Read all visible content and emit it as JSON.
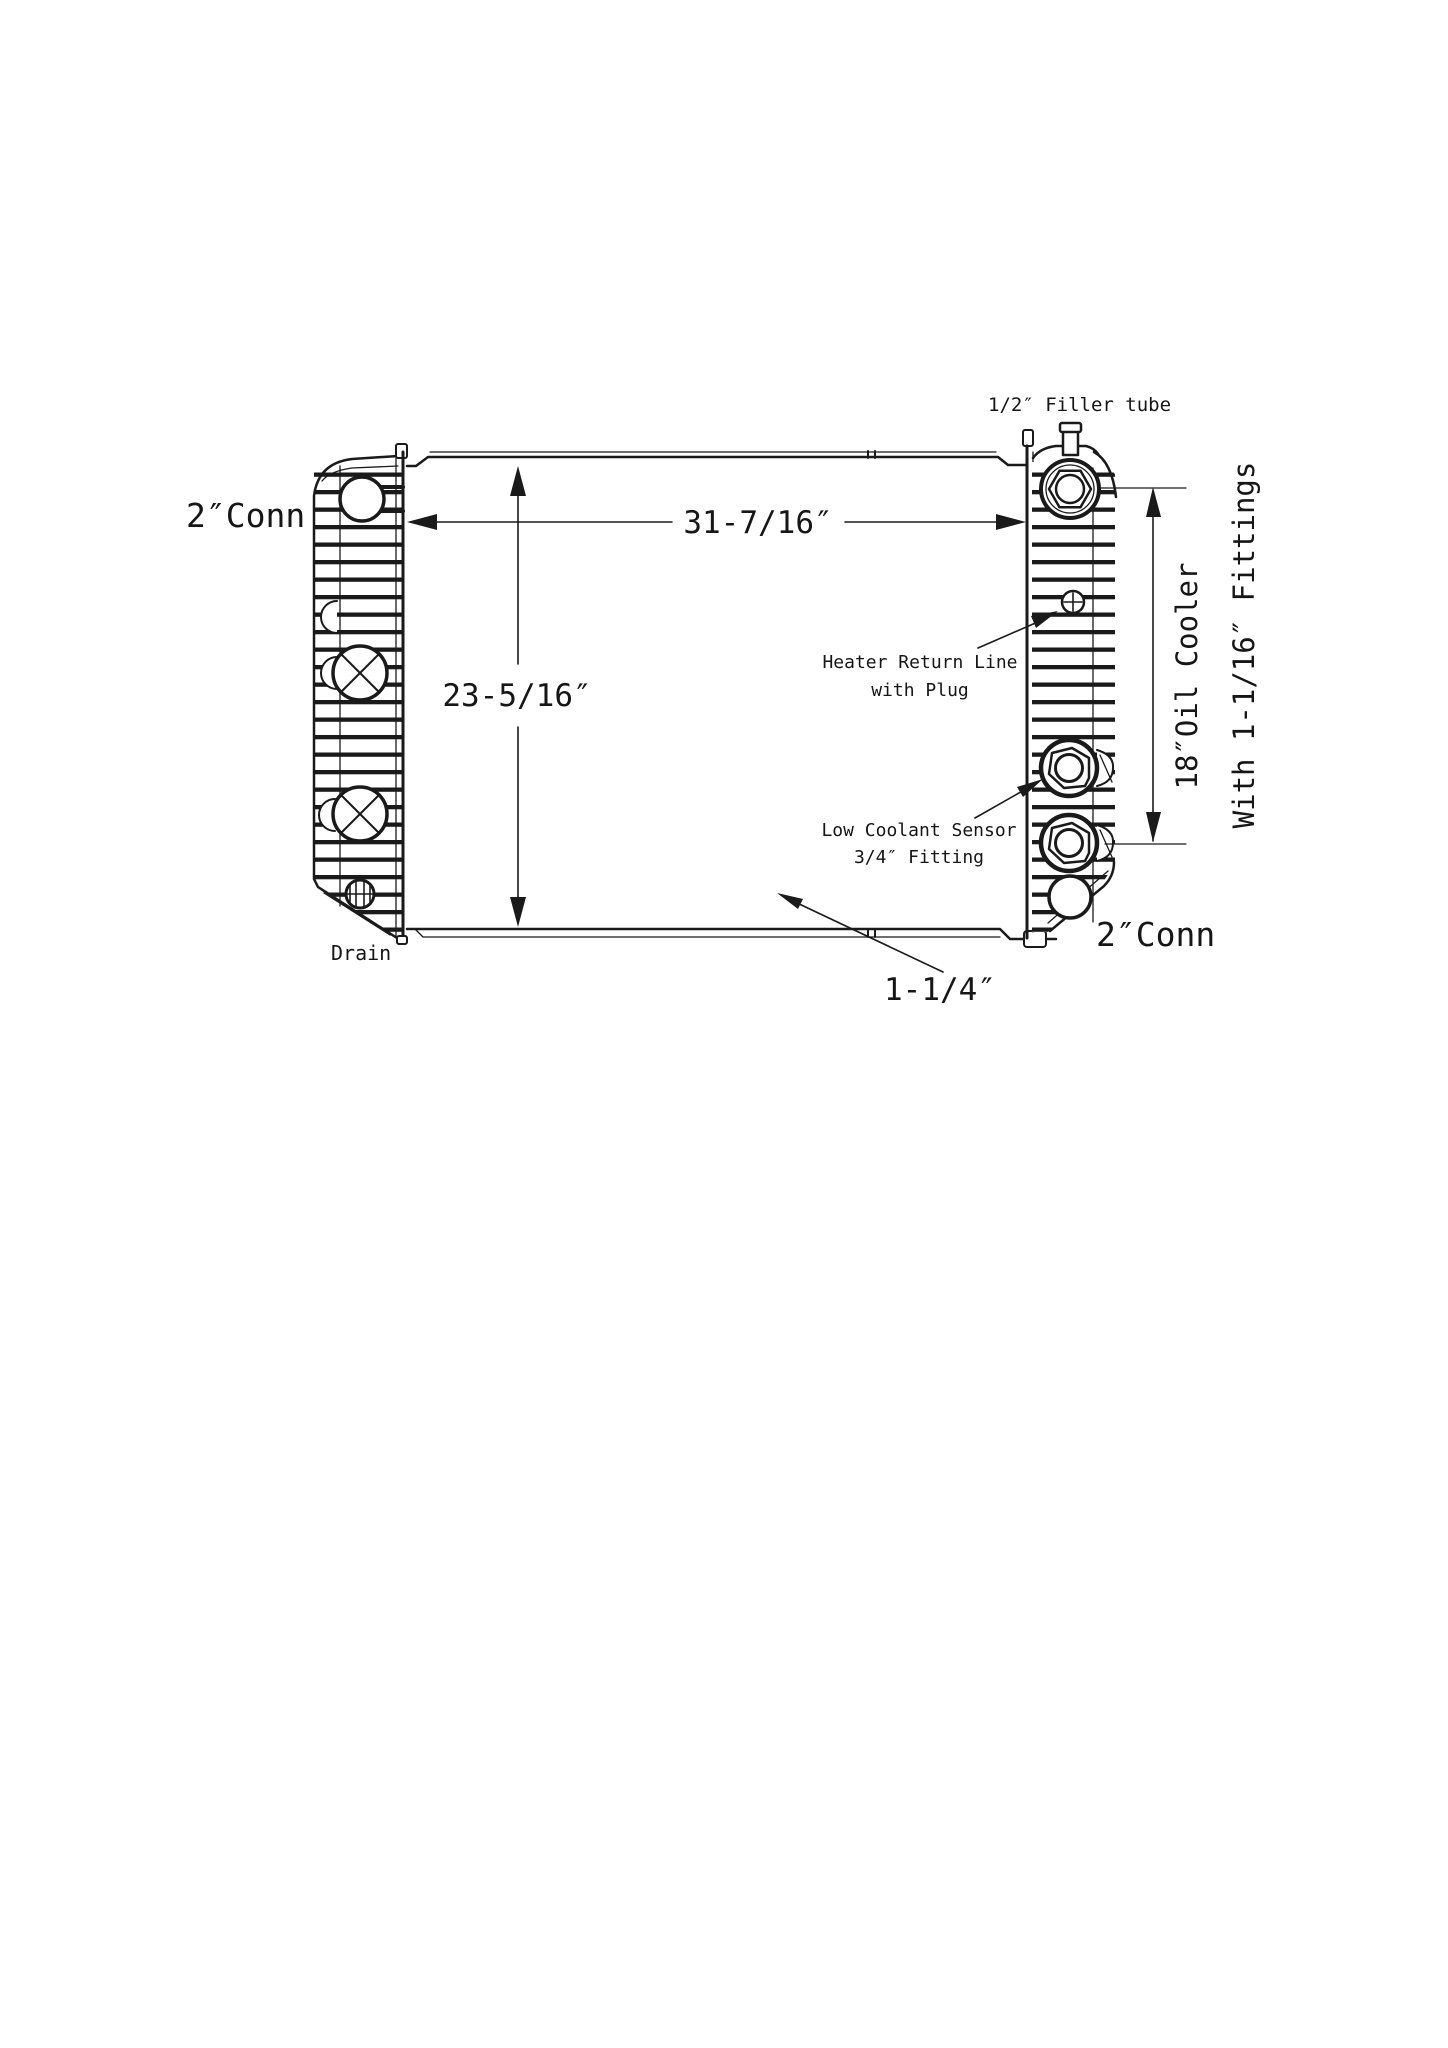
{
  "drawing": {
    "background": "#ffffff",
    "line_color": "#1a1a1a",
    "labels": {
      "top_left_conn": "2″Conn",
      "filler_tube": "1/2″ Filler tube",
      "heater_return_l1": "Heater Return Line",
      "heater_return_l2": "with Plug",
      "low_coolant_l1": "Low Coolant Sensor",
      "low_coolant_l2": "3/4″ Fitting",
      "bottom_right_conn": "2″Conn",
      "drain": "Drain",
      "oil_cooler_vertical": "18″Oil Cooler",
      "oil_cooler_fittings_vertical": "With 1-1/16″ Fittings"
    },
    "dimensions": {
      "core_width": "31-7/16″",
      "core_height": "23-5/16″",
      "bottom_tube": "1-1/4″"
    }
  }
}
